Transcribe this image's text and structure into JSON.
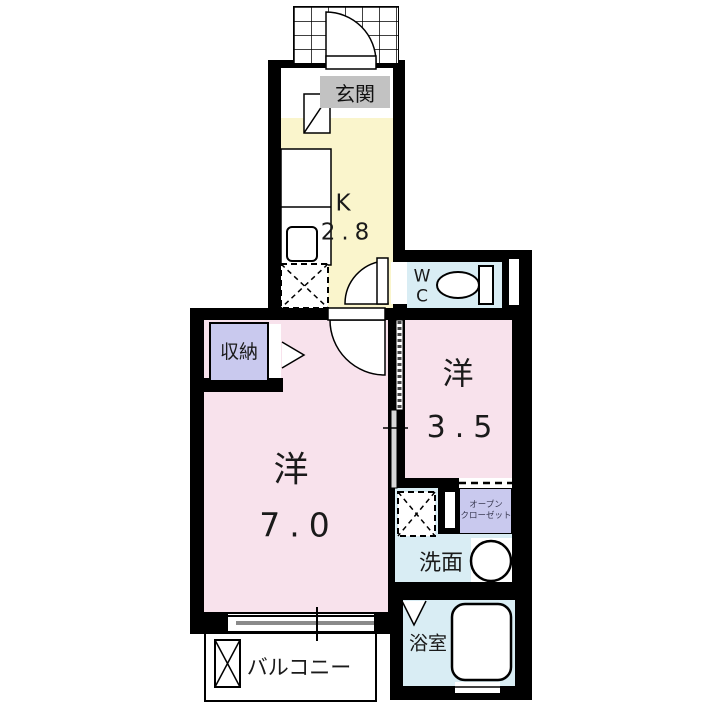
{
  "plan_title": "1K floor plan",
  "colors": {
    "wall": "#000000",
    "room_pink": "#f8e2ec",
    "kitchen_yellow": "#faf5cc",
    "wet_area_blue": "#d9edf4",
    "closet_lavender": "#c9c9ee",
    "entrance_gray": "#c2c2c2",
    "balcony_white": "#ffffff"
  },
  "rooms": {
    "entrance": {
      "label": "玄関"
    },
    "kitchen": {
      "letter": "K",
      "area": "2.8"
    },
    "wc": {
      "line1": "W",
      "line2": "C"
    },
    "storage": {
      "label": "収納"
    },
    "western_main": {
      "label": "洋",
      "area": "7.0"
    },
    "western_small": {
      "label": "洋",
      "area": "3.5"
    },
    "open_closet": {
      "line1": "オープン",
      "line2": "クローゼット"
    },
    "washroom": {
      "label": "洗面"
    },
    "bathroom": {
      "label": "浴室"
    },
    "balcony": {
      "label": "バルコニー"
    }
  }
}
